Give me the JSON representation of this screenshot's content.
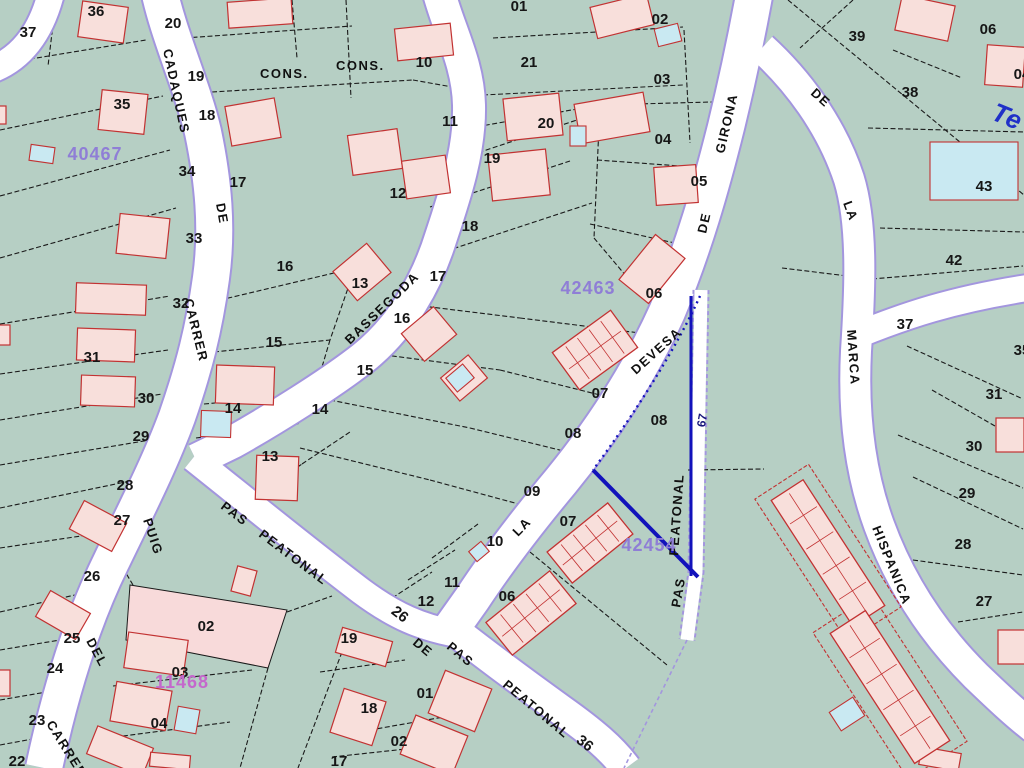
{
  "map": {
    "background_color": "#b6cfc4",
    "road_fill": "#ffffff",
    "road_edge_color": "#a396de",
    "parcel_line_color": "#1a1a1a",
    "building_fill": "#f8dfdb",
    "building_stroke": "#c23232",
    "pool_fill": "#c9e9f2",
    "highlight_parcel_fill": "#f8dada",
    "cadastral_ref_color": "#8f7ed6",
    "cadastral_ref_alt_color": "#c468cc",
    "measurement_color": "#1212bb",
    "poi_text_color": "#2030c8"
  },
  "street_labels": [
    {
      "text": "CADAQUES",
      "x": 163,
      "y": 50,
      "rot": 78
    },
    {
      "text": "DE",
      "x": 216,
      "y": 204,
      "rot": 80
    },
    {
      "text": "CARRER",
      "x": 184,
      "y": 300,
      "rot": 76
    },
    {
      "text": "PUIG",
      "x": 143,
      "y": 520,
      "rot": 72
    },
    {
      "text": "DEL",
      "x": 86,
      "y": 641,
      "rot": 62
    },
    {
      "text": "CARRER",
      "x": 46,
      "y": 724,
      "rot": 58
    },
    {
      "text": "BASSEGODA",
      "x": 350,
      "y": 345,
      "rot": -44
    },
    {
      "text": "DEVESA",
      "x": 636,
      "y": 375,
      "rot": -42
    },
    {
      "text": "LA",
      "x": 518,
      "y": 537,
      "rot": -46
    },
    {
      "text": "GIRONA",
      "x": 724,
      "y": 154,
      "rot": -77
    },
    {
      "text": "DE",
      "x": 706,
      "y": 234,
      "rot": -77
    },
    {
      "text": "DE",
      "x": 810,
      "y": 94,
      "rot": 42
    },
    {
      "text": "LA",
      "x": 843,
      "y": 203,
      "rot": 70
    },
    {
      "text": "MARCA",
      "x": 847,
      "y": 330,
      "rot": 86
    },
    {
      "text": "HISPANICA",
      "x": 872,
      "y": 528,
      "rot": 68
    },
    {
      "text": "PAS",
      "x": 220,
      "y": 508,
      "rot": 37
    },
    {
      "text": "PEATONAL",
      "x": 258,
      "y": 536,
      "rot": 37
    },
    {
      "text": "DE",
      "x": 412,
      "y": 644,
      "rot": 40
    },
    {
      "text": "PAS",
      "x": 446,
      "y": 648,
      "rot": 40
    },
    {
      "text": "PEATONAL",
      "x": 502,
      "y": 686,
      "rot": 40
    },
    {
      "text": "PEATONAL",
      "x": 678,
      "y": 556,
      "rot": -86
    },
    {
      "text": "PAS",
      "x": 680,
      "y": 608,
      "rot": -80
    },
    {
      "text": "CONS.",
      "x": 260,
      "y": 78,
      "rot": 0
    },
    {
      "text": "CONS.",
      "x": 336,
      "y": 70,
      "rot": 0
    }
  ],
  "parcel_numbers": [
    [
      "36",
      96,
      16
    ],
    [
      "20",
      173,
      28
    ],
    [
      "37",
      28,
      37
    ],
    [
      "35",
      122,
      109
    ],
    [
      "19",
      196,
      81
    ],
    [
      "18",
      207,
      120
    ],
    [
      "34",
      187,
      176
    ],
    [
      "17",
      238,
      187
    ],
    [
      "33",
      194,
      243
    ],
    [
      "32",
      181,
      308
    ],
    [
      "31",
      92,
      362
    ],
    [
      "30",
      146,
      403
    ],
    [
      "29",
      141,
      441
    ],
    [
      "28",
      125,
      490
    ],
    [
      "27",
      122,
      525
    ],
    [
      "26",
      92,
      581
    ],
    [
      "25",
      72,
      643
    ],
    [
      "24",
      55,
      673
    ],
    [
      "23",
      37,
      725
    ],
    [
      "22",
      17,
      766
    ],
    [
      "16",
      285,
      271
    ],
    [
      "15",
      274,
      347
    ],
    [
      "14",
      233,
      413
    ],
    [
      "13",
      270,
      461
    ],
    [
      "14",
      320,
      414
    ],
    [
      "10",
      424,
      67
    ],
    [
      "21",
      529,
      67
    ],
    [
      "11",
      450,
      126
    ],
    [
      "20",
      546,
      128
    ],
    [
      "12",
      398,
      198
    ],
    [
      "19",
      492,
      163
    ],
    [
      "18",
      470,
      231
    ],
    [
      "17",
      438,
      281
    ],
    [
      "16",
      402,
      323
    ],
    [
      "15",
      365,
      375
    ],
    [
      "13",
      360,
      288
    ],
    [
      "01",
      519,
      11
    ],
    [
      "02",
      660,
      24
    ],
    [
      "03",
      662,
      84
    ],
    [
      "04",
      663,
      144
    ],
    [
      "05",
      699,
      186
    ],
    [
      "06",
      654,
      298
    ],
    [
      "07",
      600,
      398
    ],
    [
      "08",
      573,
      438
    ],
    [
      "08",
      659,
      425
    ],
    [
      "09",
      532,
      496
    ],
    [
      "07",
      568,
      526
    ],
    [
      "10",
      495,
      546
    ],
    [
      "11",
      452,
      587
    ],
    [
      "12",
      426,
      606
    ],
    [
      "06",
      507,
      601
    ],
    [
      "39",
      857,
      41
    ],
    [
      "38",
      910,
      97
    ],
    [
      "06",
      988,
      34
    ],
    [
      "04",
      1022,
      79
    ],
    [
      "43",
      984,
      191
    ],
    [
      "42",
      954,
      265
    ],
    [
      "37",
      905,
      329
    ],
    [
      "35",
      1022,
      355
    ],
    [
      "31",
      994,
      399
    ],
    [
      "30",
      974,
      451
    ],
    [
      "29",
      967,
      498
    ],
    [
      "28",
      963,
      549
    ],
    [
      "27",
      984,
      606
    ],
    [
      "19",
      349,
      643
    ],
    [
      "01",
      425,
      698
    ],
    [
      "18",
      369,
      713
    ],
    [
      "02",
      399,
      746
    ],
    [
      "17",
      339,
      766
    ],
    [
      "02",
      206,
      631
    ],
    [
      "03",
      180,
      677
    ],
    [
      "04",
      159,
      728
    ],
    [
      "26",
      397,
      618,
      38
    ],
    [
      "36",
      582,
      747,
      38
    ]
  ],
  "cadastral_refs": [
    [
      "40467",
      95,
      160,
      "main"
    ],
    [
      "42463",
      588,
      294,
      "main"
    ],
    [
      "42454",
      649,
      551,
      "main"
    ],
    [
      "11468",
      182,
      688,
      "alt"
    ]
  ],
  "measurement_label": {
    "text": "67",
    "x": 706,
    "y": 421,
    "rot": -80
  },
  "poi_label": {
    "text": "Te",
    "x": 990,
    "y": 119,
    "rot": 22
  }
}
